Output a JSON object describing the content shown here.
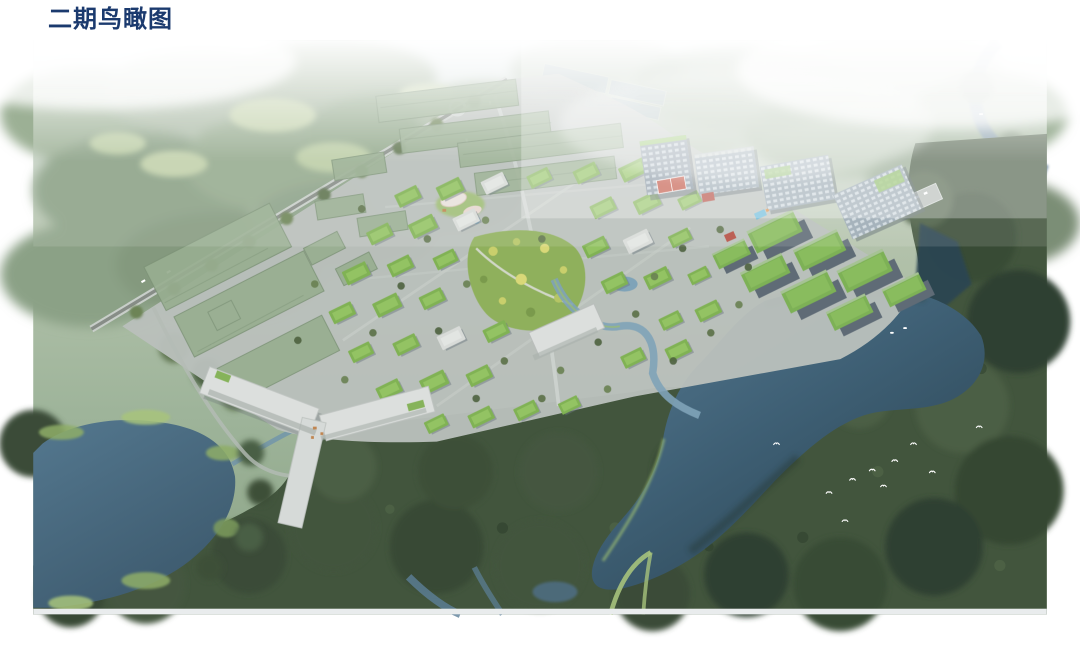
{
  "header": {
    "title": "二期鸟瞰图"
  },
  "colors": {
    "title_text": "#1b3a6e",
    "header_bg": "#ffffff",
    "sky": "#dfe7ec",
    "haze_white": "#f2f5f6",
    "hazy_forest": "#a0b29a",
    "hazy_forest_dark": "#879c81",
    "meadow": "#c2d1ab",
    "paddy": "#93a9b6",
    "river": "#6f8ba1",
    "ground": "#b9c0bb",
    "road_light": "#c8cec9",
    "road_dark": "#878d87",
    "ghost": "#98ae91",
    "ghost_dark": "#7e9478",
    "villa_roof": "#80b254",
    "villa_roof_light": "#99c868",
    "villa_wall": "#d7dad6",
    "villa_shadow": "#6e7a82",
    "block_facade": "#5f6b76",
    "block_roof": "#7db156",
    "slab_facade": "#9aa9b3",
    "slab_window": "#cfd9de",
    "white_building": "#dcdfdd",
    "white_shade": "#a9b0ac",
    "forest_dark": "#42553d",
    "forest_darker": "#31422e",
    "forest_mid": "#55694c",
    "lake_top": "#577b93",
    "lake_deep": "#2b4452",
    "lake_bl": "#54788f",
    "lake_bl_deep": "#3d5a6e",
    "shore_grass": "#9cbd72",
    "park": "#8fb05c",
    "park_tree": "#c9cf6c",
    "court_red": "#c0503f",
    "pool": "#62b7d8",
    "bird": "#ffffff",
    "bottom_strip": "#e9eced"
  }
}
